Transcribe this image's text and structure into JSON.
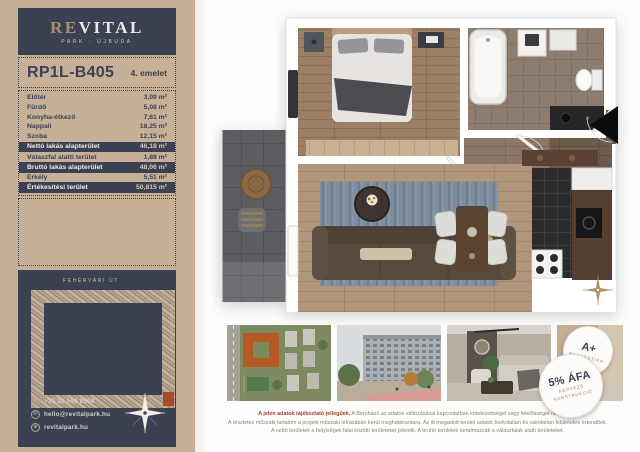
{
  "brand": {
    "logo_re": "RE",
    "logo_vital": "VITAL",
    "subtitle": "PARK · ÚJBUDA"
  },
  "unit": {
    "id": "RP1L-B405",
    "floor": "4. emelet"
  },
  "areas": {
    "rows": [
      {
        "label": "Előtér",
        "value": "3,09 m²",
        "highlight": false
      },
      {
        "label": "Fürdő",
        "value": "5,08 m²",
        "highlight": false
      },
      {
        "label": "Konyha-étkező",
        "value": "7,61 m²",
        "highlight": false
      },
      {
        "label": "Nappali",
        "value": "18,25 m²",
        "highlight": false
      },
      {
        "label": "Szoba",
        "value": "12,15 m²",
        "highlight": false
      },
      {
        "label": "Nettó lakás alapterület",
        "value": "46,18 m²",
        "highlight": true
      },
      {
        "label": "Válaszfal alatti terület",
        "value": "1,88 m²",
        "highlight": false
      },
      {
        "label": "Bruttó lakás alapterület",
        "value": "48,06 m²",
        "highlight": true
      },
      {
        "label": "Erkély",
        "value": "5,51 m²",
        "highlight": false
      },
      {
        "label": "Értékesítési terület",
        "value": "50,815 m²",
        "highlight": true
      }
    ]
  },
  "siteplan": {
    "street_top": "FEHÉRVÁRI ÚT",
    "street_right": "BARÁZDA UTCA"
  },
  "contact": {
    "items": [
      {
        "icon": "phone-icon",
        "glyph": "✆",
        "text": "+36 30 568 0504"
      },
      {
        "icon": "email-icon",
        "glyph": "✉",
        "text": "hello@revitalpark.hu"
      },
      {
        "icon": "globe-icon",
        "glyph": "⊕",
        "text": "revitalpark.hu"
      }
    ]
  },
  "badges": [
    {
      "title": "A+",
      "subtitle": "ENERGETIKA"
    },
    {
      "title": "5% ÁFA",
      "subtitle_line1": "KEDVEZŐ",
      "subtitle_line2": "KONSTRUKCIÓ"
    }
  ],
  "disclaimer": {
    "intro": "A jelen adatok tájékoztató jellegűek.",
    "line1_rest": " A Beruházó az adatok változásával kapcsolatban kötelezettséget vagy felelősséget nem vállal.",
    "line2": "A részletes műszaki tartalom a projekt műszaki leírásában kerül meghatározásra. Az itt megadott terület adatok burkolatlan és vakolatlan felületekre értendőek.",
    "line3": "A nettó területek a helyiségek falai közötti területeket jelentik. A bruttó területek tartalmazzák a válaszfalak alatti területeket."
  },
  "colors": {
    "tan": "#c7b098",
    "navy": "#3b4152",
    "highlight_unit": "#a8492c",
    "disclaimer_accent": "#9e4234"
  }
}
